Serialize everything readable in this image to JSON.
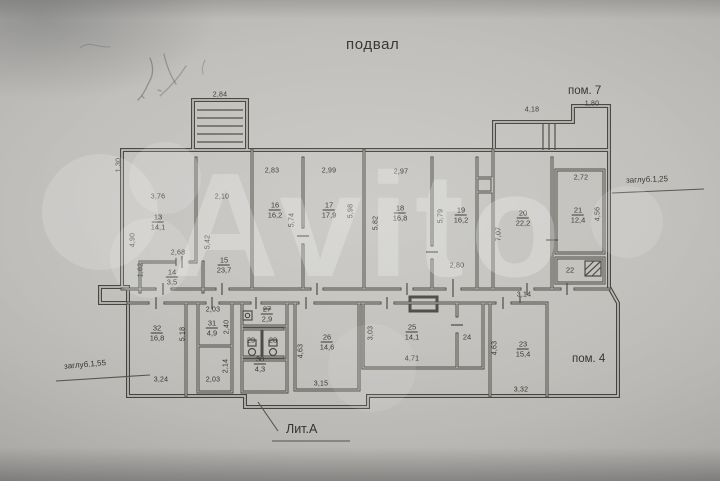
{
  "title": "подвал",
  "watermark": {
    "text": "Avito"
  },
  "annotations": {
    "pom7": "пом. 7",
    "pom4": "пом. 4",
    "litA": "Лит.А",
    "zaglub_right": "заглуб.1,25",
    "zaglub_left": "заглуб.1,55"
  },
  "colors": {
    "paper": "#bdbcb8",
    "ink": "#34332e",
    "wall": "#44423c",
    "watermark_white": "#ffffff"
  },
  "plan": {
    "rooms": [
      {
        "num": "13",
        "area": "14,1",
        "x": 158,
        "y": 222
      },
      {
        "num": "14",
        "area": "3,5",
        "x": 172,
        "y": 277
      },
      {
        "num": "15",
        "area": "23,7",
        "x": 224,
        "y": 265
      },
      {
        "num": "16",
        "area": "16,2",
        "x": 275,
        "y": 210
      },
      {
        "num": "17",
        "area": "17,9",
        "x": 329,
        "y": 210
      },
      {
        "num": "18",
        "area": "16,8",
        "x": 400,
        "y": 213
      },
      {
        "num": "19",
        "area": "16,2",
        "x": 461,
        "y": 215
      },
      {
        "num": "20",
        "area": "22,2",
        "x": 523,
        "y": 218
      },
      {
        "num": "21",
        "area": "12,4",
        "x": 578,
        "y": 215
      },
      {
        "num": "22",
        "x": 570,
        "y": 270
      },
      {
        "num": "23",
        "area": "15,4",
        "x": 523,
        "y": 349
      },
      {
        "num": "24",
        "x": 467,
        "y": 337
      },
      {
        "num": "25",
        "area": "14,1",
        "x": 412,
        "y": 332
      },
      {
        "num": "26",
        "area": "14,6",
        "x": 327,
        "y": 342
      },
      {
        "num": "27",
        "area": "2,9",
        "x": 267,
        "y": 314,
        "struck": true
      },
      {
        "num": "28",
        "x": 273,
        "y": 340
      },
      {
        "num": "29",
        "x": 251,
        "y": 340
      },
      {
        "num": "30",
        "area": "4,3",
        "x": 260,
        "y": 364
      },
      {
        "num": "31",
        "area": "4,9",
        "x": 212,
        "y": 328
      },
      {
        "num": "32",
        "area": "16,8",
        "x": 157,
        "y": 333
      }
    ],
    "dims": [
      {
        "t": "2,84",
        "x": 220,
        "y": 95
      },
      {
        "t": "4,18",
        "x": 532,
        "y": 110
      },
      {
        "t": "1,80",
        "x": 592,
        "y": 104
      },
      {
        "t": "3,76",
        "x": 158,
        "y": 197
      },
      {
        "t": "2,10",
        "x": 222,
        "y": 197
      },
      {
        "t": "2,83",
        "x": 272,
        "y": 171
      },
      {
        "t": "2,99",
        "x": 329,
        "y": 171
      },
      {
        "t": "2,97",
        "x": 401,
        "y": 172
      },
      {
        "t": "2,72",
        "x": 581,
        "y": 178
      },
      {
        "t": "2,68",
        "x": 178,
        "y": 253
      },
      {
        "t": "2,80",
        "x": 457,
        "y": 266
      },
      {
        "t": "3,14",
        "x": 524,
        "y": 295
      },
      {
        "t": "2,03",
        "x": 213,
        "y": 310
      },
      {
        "t": "3,24",
        "x": 161,
        "y": 380
      },
      {
        "t": "2,03",
        "x": 213,
        "y": 380
      },
      {
        "t": "3,15",
        "x": 321,
        "y": 384
      },
      {
        "t": "4,71",
        "x": 412,
        "y": 359
      },
      {
        "t": "3,32",
        "x": 521,
        "y": 390
      },
      {
        "t": "1,30",
        "x": 119,
        "y": 165,
        "v": 1
      },
      {
        "t": "4,90",
        "x": 133,
        "y": 240,
        "v": 1
      },
      {
        "t": "1,62",
        "x": 141,
        "y": 270,
        "v": 1
      },
      {
        "t": "5,42",
        "x": 208,
        "y": 242,
        "v": 1
      },
      {
        "t": "5,74",
        "x": 292,
        "y": 220,
        "v": 1
      },
      {
        "t": "5,98",
        "x": 351,
        "y": 211,
        "v": 1
      },
      {
        "t": "5,82",
        "x": 376,
        "y": 223,
        "v": 1
      },
      {
        "t": "5,79",
        "x": 441,
        "y": 216,
        "v": 1
      },
      {
        "t": "7,07",
        "x": 499,
        "y": 234,
        "v": 1
      },
      {
        "t": "4,56",
        "x": 598,
        "y": 214,
        "v": 1
      },
      {
        "t": "5,18",
        "x": 183,
        "y": 334,
        "v": 1
      },
      {
        "t": "2,40",
        "x": 227,
        "y": 327,
        "v": 1
      },
      {
        "t": "2,14",
        "x": 226,
        "y": 366,
        "v": 1
      },
      {
        "t": "4,63",
        "x": 301,
        "y": 351,
        "v": 1
      },
      {
        "t": "3,03",
        "x": 371,
        "y": 333,
        "v": 1
      },
      {
        "t": "4,63",
        "x": 495,
        "y": 348,
        "v": 1
      }
    ]
  }
}
